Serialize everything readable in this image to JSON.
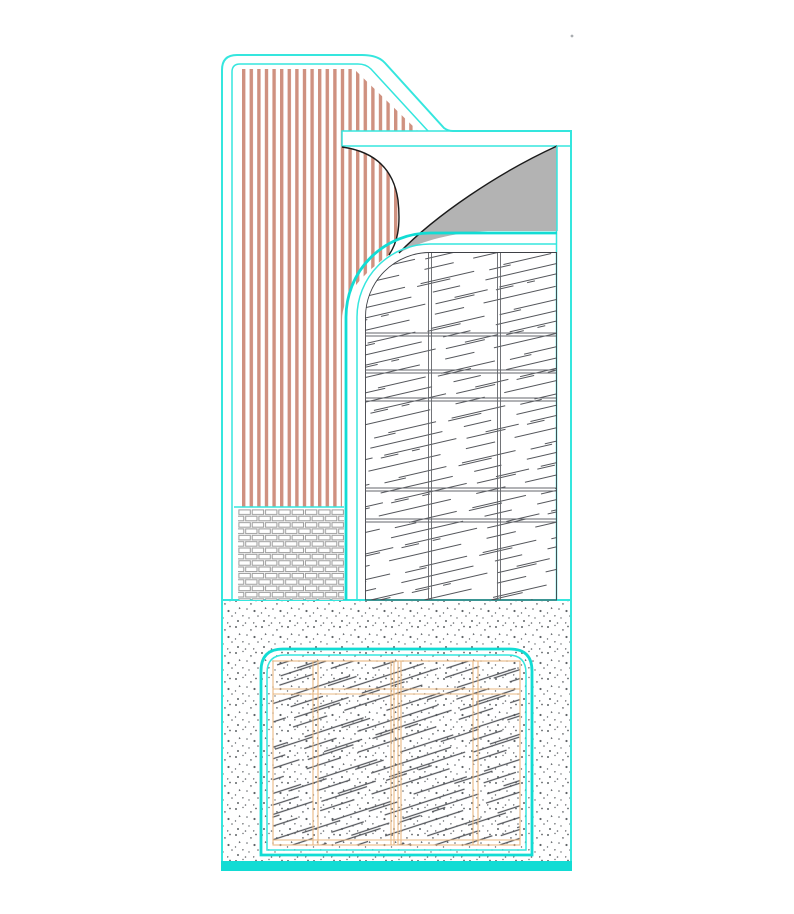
{
  "meta": {
    "description": "CAD architectural detail section drawing on a white canvas, no visible text labels",
    "visible_text": []
  },
  "canvas": {
    "width": 794,
    "height": 914,
    "background": "#ffffff"
  },
  "colors": {
    "cyan": "#35e6de",
    "cyan_strong": "#12dcd4",
    "salmon": "#cf9180",
    "gray_fill": "#b3b3b3",
    "hatch_dark": "#54565b",
    "grid_gray": "#63666b",
    "brick_gray": "#9b9b9b",
    "orange": "#e9b883",
    "stipple_gray": "#606468",
    "black": "#1b1b1b",
    "dot_artifact": "#a9adb0",
    "bg": "#ffffff"
  },
  "regions": [
    {
      "id": "outer-boundary",
      "desc": "cyan polyline outline of whole detail with rounded top-left corner and 45-degree chamfer to upper shelf"
    },
    {
      "id": "siding-stripes-panel",
      "desc": "tall left panel filled with vertical salmon stripes"
    },
    {
      "id": "brick-base",
      "desc": "running-bond brick hatch block under the striped panel"
    },
    {
      "id": "ledge-slab",
      "desc": "thin horizontal white band with cyan outline at top right"
    },
    {
      "id": "peel-shape",
      "desc": "gray curved wedge (membrane peel) between slab and arch"
    },
    {
      "id": "arch-hatch-panel",
      "desc": "large round-cornered panel with diagonal broken-line hatch and thin double grid lines"
    },
    {
      "id": "concrete-footing",
      "desc": "stippled concrete block across the bottom with thick cyan base bar"
    },
    {
      "id": "window-hatch-panel",
      "desc": "rounded rectangle inside footing with diagonal hatch and orange grid lines"
    }
  ]
}
